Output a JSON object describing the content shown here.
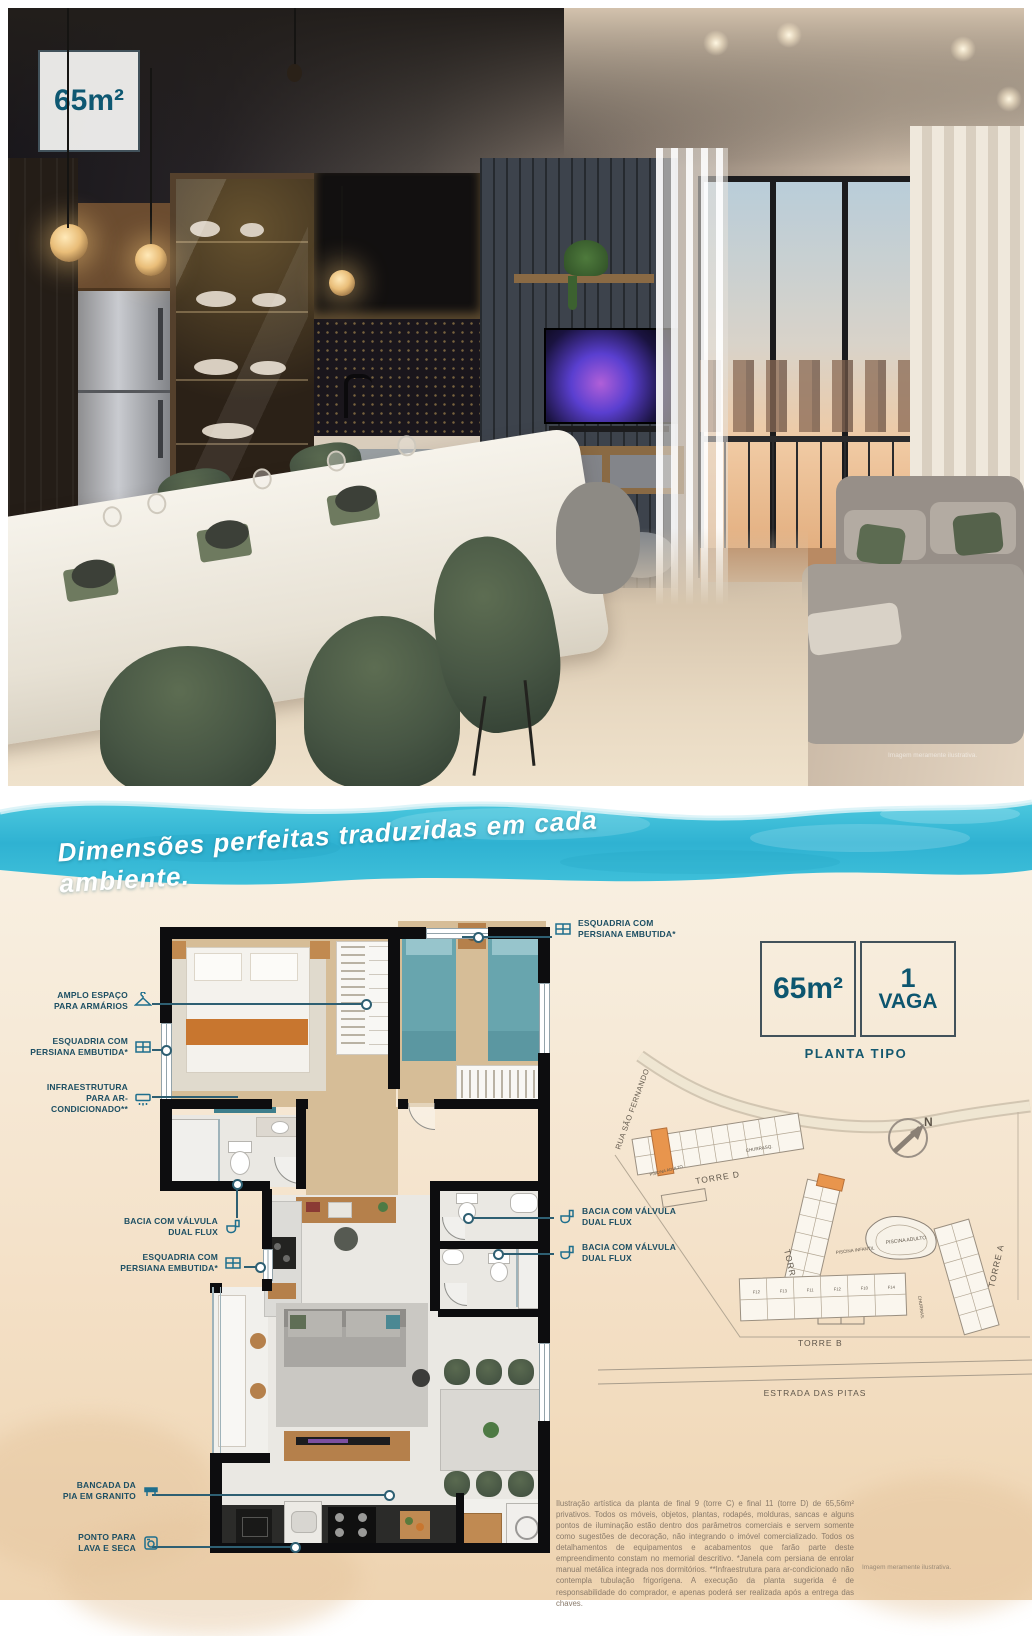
{
  "photo": {
    "area_badge": "65m²",
    "disclaimer": "Imagem meramente ilustrativa."
  },
  "banner": {
    "text": "Dimensões perfeitas traduzidas em cada ambiente."
  },
  "floorplan": {
    "annotations_left": [
      {
        "label": "AMPLO ESPAÇO\nPARA ARMÁRIOS",
        "icon": "hanger-icon"
      },
      {
        "label": "ESQUADRIA COM\nPERSIANA EMBUTIDA*",
        "icon": "window-icon"
      },
      {
        "label": "INFRAESTRUTURA\nPARA AR-CONDICIONADO**",
        "icon": "ac-icon"
      },
      {
        "label": "BACIA COM VÁLVULA\nDUAL FLUX",
        "icon": "toilet-icon"
      },
      {
        "label": "ESQUADRIA COM\nPERSIANA EMBUTIDA*",
        "icon": "window-icon"
      },
      {
        "label": "BANCADA DA\nPIA EM GRANITO",
        "icon": "counter-icon"
      },
      {
        "label": "PONTO PARA\nLAVA E SECA",
        "icon": "washer-icon"
      }
    ],
    "annotation_top": {
      "label": "ESQUADRIA COM\nPERSIANA EMBUTIDA*",
      "icon": "window-icon"
    },
    "annotations_right": [
      {
        "label": "BACIA COM VÁLVULA\nDUAL FLUX",
        "icon": "toilet-icon"
      },
      {
        "label": "BACIA COM VÁLVULA\nDUAL FLUX",
        "icon": "toilet-icon"
      }
    ]
  },
  "specs": {
    "area": "65m²",
    "parking_value": "1",
    "parking_label": "VAGA",
    "caption": "PLANTA TIPO"
  },
  "siteplan": {
    "street": "RUA SÃO FERNANDO",
    "road": "ESTRADA DAS PITAS",
    "towers": {
      "a": "TORRE A",
      "b": "TORRE B",
      "c": "TORRE C",
      "d": "TORRE D"
    },
    "amenities": {
      "pool_adult": "PISCINA ADULTO",
      "pool_kids": "PISCINA INFANTIL",
      "bbq": "CHURRASQ.",
      "bbq2": "CHURRAS.",
      "pool_adult_top": "PISCINA ADULTO"
    },
    "compass": "N",
    "unit_labels": [
      "F12",
      "F13",
      "F11",
      "F12",
      "F10",
      "F14"
    ]
  },
  "legal": "Ilustração artística da planta de final 9 (torre C) e final 11 (torre D) de 65,56m² privativos. Todos os móveis, objetos, plantas, rodapés, molduras, sancas e alguns pontos de iluminação estão dentro dos parâmetros comerciais e servem somente como sugestões de decoração, não integrando o imóvel comercializado. Todos os detalhamentos de equipamentos e acabamentos que farão parte deste empreendimento constam no memorial descritivo. *Janela com persiana de enrolar manual metálica integrada nos dormitórios. **Infraestrutura para ar-condicionado não contempla tubulação frigorígena. A execução da planta sugerida é de responsabilidade do comprador, e apenas poderá ser realizada após a entrega das chaves.",
  "page_disclaimer": "Imagem meramente ilustrativa."
}
